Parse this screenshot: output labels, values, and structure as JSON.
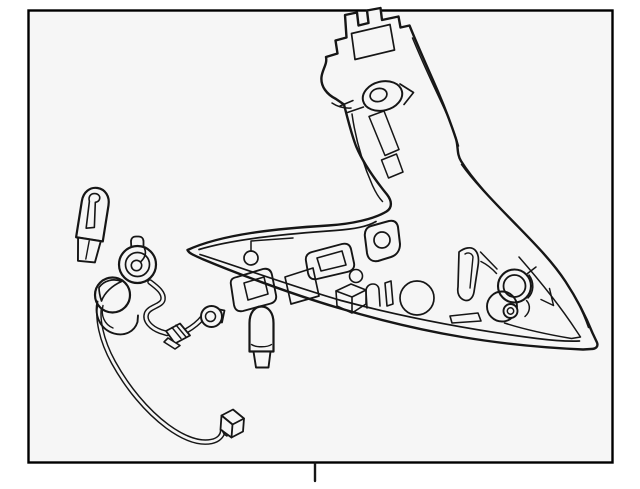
{
  "title": "Tail lamp assembly and wiring harness parts diagram",
  "colors": {
    "page_bg": "#ffffff",
    "panel_bg": "#f6f6f6",
    "line": "#161616",
    "border": "#000000"
  },
  "panel": {
    "x": 28,
    "y": 10,
    "width": 585,
    "height": 453,
    "border_width": 2.4
  },
  "callout_tick": {
    "x": 315,
    "y1": 464,
    "y2": 481
  },
  "parts": [
    "tail-lamp-unit",
    "mounting-bracket",
    "lamp-socket-holes",
    "bulb-socket-grommets",
    "harness-socket-large",
    "harness-socket-small",
    "harness-wire",
    "harness-connector",
    "wedge-bulb-upper",
    "wedge-bulb-lower",
    "callout-tick"
  ]
}
